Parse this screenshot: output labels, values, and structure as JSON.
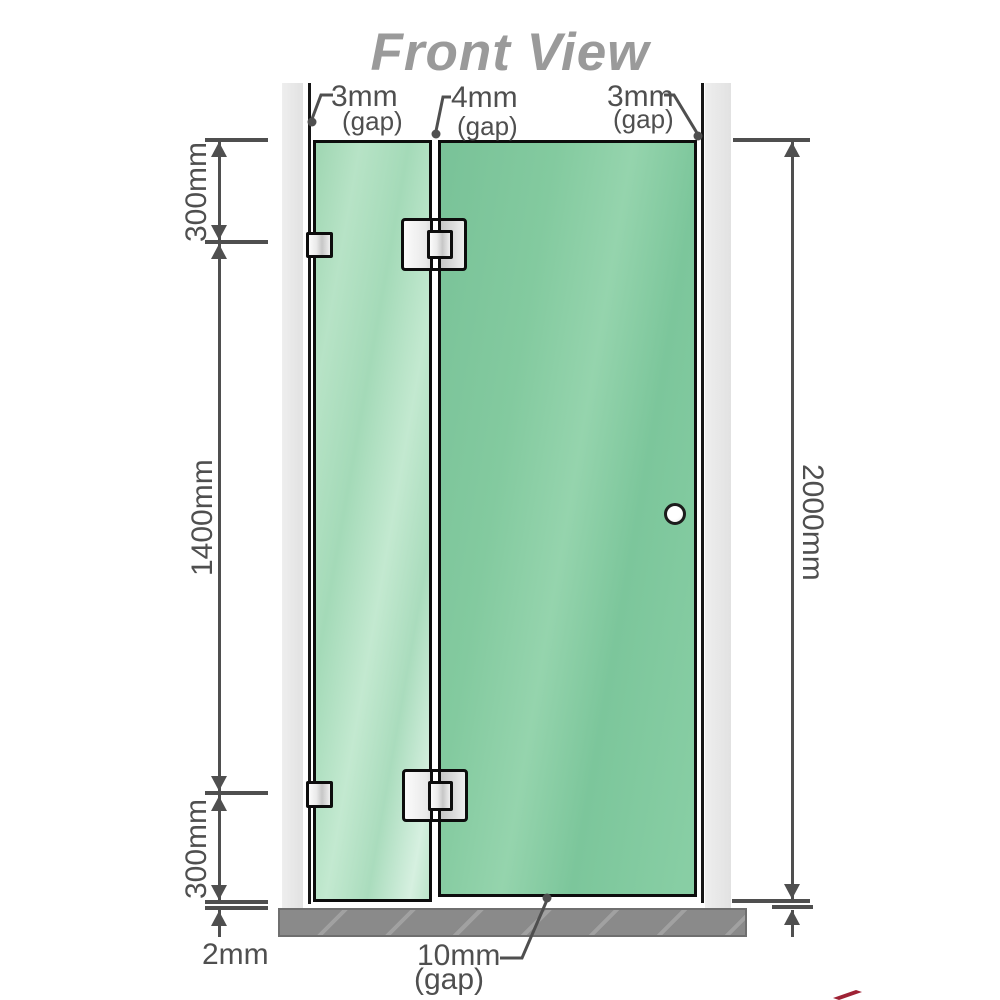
{
  "title": "Front View",
  "labels": {
    "gap_top_left": {
      "value": "3mm",
      "note": "(gap)"
    },
    "gap_top_middle": {
      "value": "4mm",
      "note": "(gap)"
    },
    "gap_top_right": {
      "value": "3mm",
      "note": "(gap)"
    },
    "segment_top": "300mm",
    "segment_middle": "1400mm",
    "segment_bottom": "300mm",
    "overall_height": "2000mm",
    "floor_clearance": "2mm",
    "door_bottom_gap": {
      "value": "10mm",
      "note": "(gap)"
    }
  },
  "colors": {
    "glass_fixed_panel": "#aaddbe",
    "glass_door_panel": "#7fc79e",
    "wall_channel": "#e9e9e9",
    "hardware_metal": "#e0e0e0",
    "floor": "#8a8a8a",
    "outline": "#111111",
    "dimension_lines": "#4f4f4f",
    "title_text": "#9a9a9a",
    "logo_fragment": "#9e2235"
  }
}
